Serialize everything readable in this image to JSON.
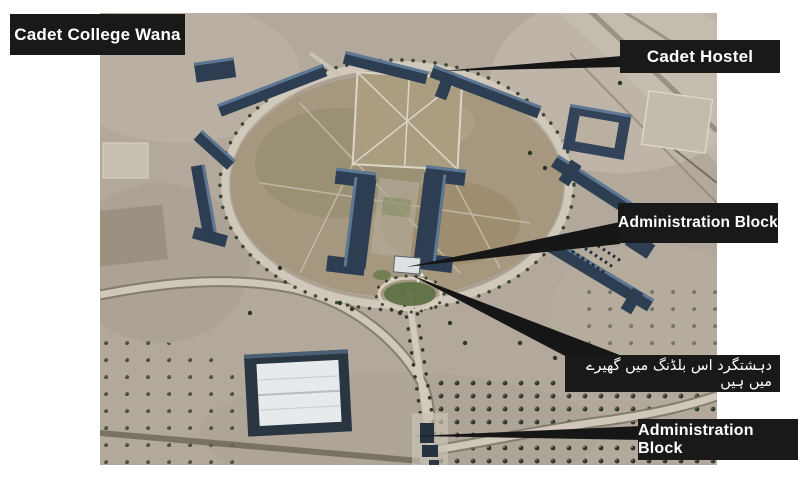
{
  "colors": {
    "page_background": "#ffffff",
    "label_background": "#191919",
    "label_text": "#ffffff",
    "arrow": "#161616",
    "terrain": "#b2a99c",
    "building_roof": "#32435a"
  },
  "annotations": {
    "college_title": "Cadet College Wana",
    "cadet_hostel": "Cadet Hostel",
    "administration_block": "Administration Block",
    "urdu_caption": "دہشتگرد اس بلڈنگ میں گھیرے میں ہیں",
    "administration_block_gate": "Administration Block"
  }
}
